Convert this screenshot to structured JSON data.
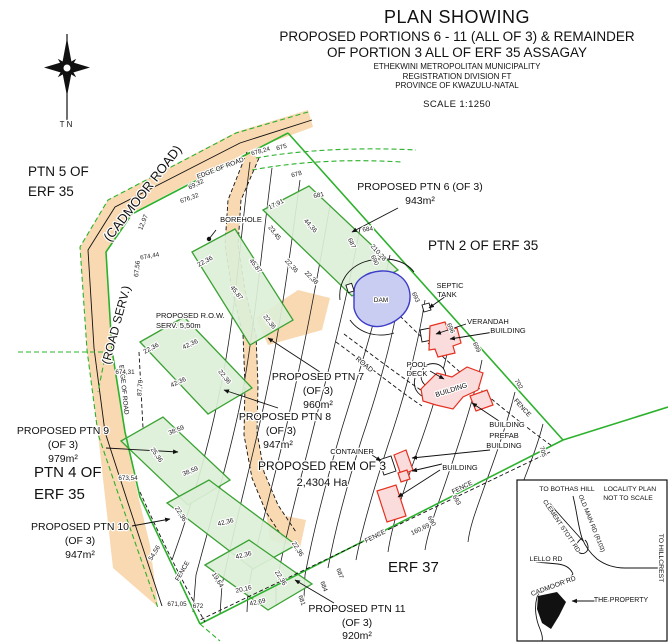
{
  "header": {
    "title1": "PLAN SHOWING",
    "title2": "PROPOSED PORTIONS 6 - 11 (ALL OF 3) & REMAINDER",
    "title3": "OF PORTION 3 ALL OF ERF 35 ASSAGAY",
    "sub1": "ETHEKWINI METROPOLITAN MUNICIPALITY",
    "sub2": "REGISTRATION DIVISION FT",
    "sub3": "PROVINCE OF KWAZULU-NATAL",
    "scale": "SCALE 1:1250"
  },
  "colors": {
    "road": "#f8d9b2",
    "green": "#2cb12c",
    "pfill": "#dcefd8",
    "pstroke": "#3aa233",
    "dfill": "#c9cdf2",
    "dstroke": "#3c3cc8",
    "bfill": "#fbdcdc",
    "bstroke": "#e5301f"
  },
  "labels": [
    {
      "n": "north-label",
      "t": "T N",
      "x": 66,
      "y": 127,
      "c": "feat",
      "s": 8
    },
    {
      "n": "area-label-ptn5",
      "t": "PTN 5 OF",
      "x": 28,
      "y": 176,
      "c": "area",
      "a": "s"
    },
    {
      "n": "area-label-ptn5b",
      "t": "ERF 35",
      "x": 28,
      "y": 196,
      "c": "area",
      "a": "s"
    },
    {
      "n": "area-label-ptn2",
      "t": "PTN 2 OF ERF 35",
      "x": 428,
      "y": 250,
      "c": "area",
      "a": "s"
    },
    {
      "n": "area-label-ptn4",
      "t": "PTN 4 OF",
      "x": 34,
      "y": 477,
      "c": "area",
      "s": 15,
      "a": "s"
    },
    {
      "n": "area-label-ptn4b",
      "t": "ERF 35",
      "x": 34,
      "y": 499,
      "c": "area",
      "s": 15,
      "a": "s"
    },
    {
      "n": "area-label-erf37",
      "t": "ERF 37",
      "x": 388,
      "y": 572,
      "c": "area",
      "s": 15,
      "a": "s"
    },
    {
      "n": "road-name-cadmoor",
      "t": "(CADMOOR ROAD)",
      "x": 146,
      "y": 196,
      "r": -52,
      "c": "area",
      "s": 13
    },
    {
      "n": "road-name-roadserv",
      "t": "(ROAD SERV.)",
      "x": 120,
      "y": 326,
      "r": -75,
      "c": "area",
      "s": 12
    },
    {
      "n": "ptn6-label",
      "t": "PROPOSED PTN 6 (OF 3)",
      "x": 420,
      "y": 190,
      "c": "ptn"
    },
    {
      "n": "ptn6-area",
      "t": "943m²",
      "x": 420,
      "y": 204,
      "c": "ptn"
    },
    {
      "n": "ptn7-label",
      "t": "PROPOSED PTN 7",
      "x": 318,
      "y": 380,
      "c": "ptn"
    },
    {
      "n": "ptn7-of3",
      "t": "(OF 3)",
      "x": 318,
      "y": 394,
      "c": "ptn"
    },
    {
      "n": "ptn7-area",
      "t": "960m²",
      "x": 318,
      "y": 408,
      "c": "ptn"
    },
    {
      "n": "ptn8-label",
      "t": "PROPOSED PTN 8",
      "x": 285,
      "y": 420,
      "c": "ptn"
    },
    {
      "n": "ptn8-of3",
      "t": "(OF 3)",
      "x": 281,
      "y": 434,
      "c": "ptn"
    },
    {
      "n": "ptn8-area",
      "t": "947m²",
      "x": 278,
      "y": 448,
      "c": "ptn"
    },
    {
      "n": "ptn9-label",
      "t": "PROPOSED PTN 9",
      "x": 63,
      "y": 434,
      "c": "ptn"
    },
    {
      "n": "ptn9-of3",
      "t": "(OF 3)",
      "x": 63,
      "y": 448,
      "c": "ptn"
    },
    {
      "n": "ptn9-area",
      "t": "979m²",
      "x": 63,
      "y": 462,
      "c": "ptn"
    },
    {
      "n": "ptn10-label",
      "t": "PROPOSED PTN 10",
      "x": 80,
      "y": 530,
      "c": "ptn"
    },
    {
      "n": "ptn10-of3",
      "t": "(OF 3)",
      "x": 80,
      "y": 544,
      "c": "ptn"
    },
    {
      "n": "ptn10-area",
      "t": "947m²",
      "x": 80,
      "y": 558,
      "c": "ptn"
    },
    {
      "n": "ptn11-label",
      "t": "PROPOSED PTN 11",
      "x": 357,
      "y": 612,
      "c": "ptn"
    },
    {
      "n": "ptn11-of3",
      "t": "(OF 3)",
      "x": 357,
      "y": 626,
      "c": "ptn"
    },
    {
      "n": "ptn11-area",
      "t": "920m²",
      "x": 357,
      "y": 639,
      "c": "ptn"
    },
    {
      "n": "rem-label",
      "t": "PROPOSED REM OF 3",
      "x": 322,
      "y": 470,
      "c": "ptn",
      "s": 12
    },
    {
      "n": "rem-area",
      "t": "2,4304 Ha",
      "x": 322,
      "y": 486,
      "c": "ptn",
      "s": 11
    },
    {
      "n": "row-serv-label",
      "t": "PROPOSED R.O.W.",
      "x": 156,
      "y": 318,
      "c": "feat",
      "a": "s"
    },
    {
      "n": "row-serv-label2",
      "t": "SERV. 5,50m",
      "x": 156,
      "y": 328,
      "c": "feat",
      "a": "s"
    },
    {
      "n": "borehole-label",
      "t": "BOREHOLE",
      "x": 241,
      "y": 222,
      "c": "feat"
    },
    {
      "n": "septic-label",
      "t": "SEPTIC",
      "x": 450,
      "y": 288,
      "c": "feat"
    },
    {
      "n": "septic-label2",
      "t": "TANK",
      "x": 447,
      "y": 297,
      "c": "feat"
    },
    {
      "n": "verandah-label",
      "t": "VERANDAH",
      "x": 488,
      "y": 324,
      "c": "feat"
    },
    {
      "n": "building-label-top",
      "t": "BUILDING",
      "x": 508,
      "y": 333,
      "c": "feat"
    },
    {
      "n": "pool-label",
      "t": "POOL",
      "x": 417,
      "y": 367,
      "c": "feat"
    },
    {
      "n": "pool-label2",
      "t": "DECK",
      "x": 417,
      "y": 376,
      "c": "feat"
    },
    {
      "n": "dam-label",
      "t": "DAM",
      "x": 381,
      "y": 302,
      "c": "feat",
      "s": 6.5
    },
    {
      "n": "building-label-main",
      "t": "BUILDING",
      "x": 452,
      "y": 392,
      "r": -18,
      "c": "feat",
      "s": 7
    },
    {
      "n": "building-label-mid",
      "t": "BUILDING",
      "x": 507,
      "y": 427,
      "c": "feat"
    },
    {
      "n": "prefab-label",
      "t": "PREFAB",
      "x": 504,
      "y": 438,
      "c": "feat"
    },
    {
      "n": "prefab-label2",
      "t": "BUILDING",
      "x": 504,
      "y": 448,
      "c": "feat"
    },
    {
      "n": "container-label",
      "t": "CONTAINER",
      "x": 352,
      "y": 454,
      "c": "feat"
    },
    {
      "n": "building-label-right",
      "t": "BUILDING",
      "x": 460,
      "y": 470,
      "c": "feat"
    },
    {
      "n": "road-label",
      "t": "ROAD",
      "x": 363,
      "y": 366,
      "r": 40,
      "c": "feat",
      "s": 7
    },
    {
      "n": "fence-label-1",
      "t": "FENCE",
      "x": 521,
      "y": 409,
      "r": 48,
      "c": "feat",
      "s": 6.5
    },
    {
      "n": "fence-label-2",
      "t": "FENCE",
      "x": 463,
      "y": 489,
      "r": -27,
      "c": "feat",
      "s": 6.5
    },
    {
      "n": "fence-label-3",
      "t": "FENCE",
      "x": 376,
      "y": 538,
      "r": -27,
      "c": "feat",
      "s": 6.5
    },
    {
      "n": "fence-label-4",
      "t": "FENCE",
      "x": 184,
      "y": 572,
      "r": -60,
      "c": "feat",
      "s": 6.5
    },
    {
      "n": "edge-of-road-label-1",
      "t": "EDGE OF ROAD",
      "x": 221,
      "y": 170,
      "r": -21,
      "c": "feat",
      "s": 6.5
    },
    {
      "n": "edge-of-road-label-2",
      "t": "EDGE OF ROAD",
      "x": 122,
      "y": 390,
      "r": 84,
      "c": "feat",
      "s": 6.5
    },
    {
      "n": "dim-label",
      "t": "69,32",
      "x": 197,
      "y": 186,
      "r": -26,
      "c": "dim"
    },
    {
      "n": "dim-label",
      "t": "12,97",
      "x": 145,
      "y": 223,
      "r": -68,
      "c": "dim"
    },
    {
      "n": "dim-label",
      "t": "67,56",
      "x": 139,
      "y": 269,
      "r": -84,
      "c": "dim"
    },
    {
      "n": "dim-label",
      "t": "87,79",
      "x": 142,
      "y": 388,
      "r": -86,
      "c": "dim"
    },
    {
      "n": "dim-label",
      "t": "210,28",
      "x": 377,
      "y": 254,
      "r": 48,
      "c": "dim"
    },
    {
      "n": "dim-label",
      "t": "160,69",
      "x": 421,
      "y": 531,
      "r": -26,
      "c": "dim"
    },
    {
      "n": "dim-label",
      "t": "54,56",
      "x": 156,
      "y": 554,
      "r": -58,
      "c": "dim"
    },
    {
      "n": "dim-label",
      "t": "17,91",
      "x": 277,
      "y": 206,
      "r": -26,
      "c": "dim"
    },
    {
      "n": "dim-label",
      "t": "23,45",
      "x": 273,
      "y": 234,
      "r": 52,
      "c": "dim"
    },
    {
      "n": "dim-label",
      "t": "44,36",
      "x": 309,
      "y": 227,
      "r": 48,
      "c": "dim"
    },
    {
      "n": "dim-label",
      "t": "22,36",
      "x": 290,
      "y": 267,
      "r": 48,
      "c": "dim"
    },
    {
      "n": "dim-label",
      "t": "22,38",
      "x": 310,
      "y": 279,
      "r": 45,
      "c": "dim"
    },
    {
      "n": "dim-label",
      "t": "22,36",
      "x": 206,
      "y": 263,
      "r": -28,
      "c": "dim"
    },
    {
      "n": "dim-label",
      "t": "45,87",
      "x": 254,
      "y": 267,
      "r": 52,
      "c": "dim"
    },
    {
      "n": "dim-label",
      "t": "45,87",
      "x": 235,
      "y": 294,
      "r": 52,
      "c": "dim"
    },
    {
      "n": "dim-label",
      "t": "22,36",
      "x": 268,
      "y": 323,
      "r": 52,
      "c": "dim"
    },
    {
      "n": "dim-label",
      "t": "22,36",
      "x": 152,
      "y": 350,
      "r": -28,
      "c": "dim"
    },
    {
      "n": "dim-label",
      "t": "42,36",
      "x": 191,
      "y": 346,
      "r": -25,
      "c": "dim"
    },
    {
      "n": "dim-label",
      "t": "42,36",
      "x": 179,
      "y": 384,
      "r": -25,
      "c": "dim"
    },
    {
      "n": "dim-label",
      "t": "22,36",
      "x": 223,
      "y": 378,
      "r": 52,
      "c": "dim"
    },
    {
      "n": "dim-label",
      "t": "38,59",
      "x": 177,
      "y": 432,
      "r": -22,
      "c": "dim"
    },
    {
      "n": "dim-label",
      "t": "25,36",
      "x": 155,
      "y": 456,
      "r": 55,
      "c": "dim"
    },
    {
      "n": "dim-label",
      "t": "38,59",
      "x": 191,
      "y": 473,
      "r": -22,
      "c": "dim"
    },
    {
      "n": "dim-label",
      "t": "22,36",
      "x": 179,
      "y": 515,
      "r": 58,
      "c": "dim"
    },
    {
      "n": "dim-label",
      "t": "42,36",
      "x": 226,
      "y": 524,
      "r": -14,
      "c": "dim"
    },
    {
      "n": "dim-label",
      "t": "42,36",
      "x": 244,
      "y": 557,
      "r": -14,
      "c": "dim"
    },
    {
      "n": "dim-label",
      "t": "22,36",
      "x": 296,
      "y": 550,
      "r": 58,
      "c": "dim"
    },
    {
      "n": "dim-label",
      "t": "19,64",
      "x": 216,
      "y": 581,
      "r": 58,
      "c": "dim"
    },
    {
      "n": "dim-label",
      "t": "20,16",
      "x": 244,
      "y": 591,
      "r": -12,
      "c": "dim"
    },
    {
      "n": "dim-label",
      "t": "42,69",
      "x": 258,
      "y": 604,
      "r": -12,
      "c": "dim"
    },
    {
      "n": "dim-label",
      "t": "22,36",
      "x": 279,
      "y": 579,
      "r": 58,
      "c": "dim"
    },
    {
      "n": "contour-label",
      "t": "675",
      "x": 282,
      "y": 149,
      "r": -15,
      "c": "cont"
    },
    {
      "n": "spot-height",
      "t": "678,24",
      "x": 261,
      "y": 153,
      "r": -15,
      "c": "cont"
    },
    {
      "n": "contour-label",
      "t": "678",
      "x": 297,
      "y": 176,
      "r": -15,
      "c": "cont"
    },
    {
      "n": "contour-label",
      "t": "681",
      "x": 319,
      "y": 197,
      "r": -12,
      "c": "cont"
    },
    {
      "n": "contour-label",
      "t": "684",
      "x": 368,
      "y": 231,
      "r": -8,
      "c": "cont"
    },
    {
      "n": "contour-label",
      "t": "687",
      "x": 350,
      "y": 244,
      "r": 65,
      "c": "cont"
    },
    {
      "n": "contour-label",
      "t": "690",
      "x": 373,
      "y": 261,
      "r": 65,
      "c": "cont"
    },
    {
      "n": "contour-label",
      "t": "693",
      "x": 414,
      "y": 298,
      "r": 65,
      "c": "cont"
    },
    {
      "n": "contour-label",
      "t": "696",
      "x": 449,
      "y": 329,
      "r": 65,
      "c": "cont"
    },
    {
      "n": "contour-label",
      "t": "699",
      "x": 475,
      "y": 348,
      "r": 65,
      "c": "cont"
    },
    {
      "n": "contour-label",
      "t": "702",
      "x": 517,
      "y": 385,
      "r": 60,
      "c": "cont"
    },
    {
      "n": "contour-label",
      "t": "705",
      "x": 541,
      "y": 452,
      "r": 75,
      "c": "cont"
    },
    {
      "n": "contour-label",
      "t": "687",
      "x": 338,
      "y": 574,
      "r": 70,
      "c": "cont"
    },
    {
      "n": "contour-label",
      "t": "684",
      "x": 322,
      "y": 587,
      "r": 70,
      "c": "cont"
    },
    {
      "n": "contour-label",
      "t": "681",
      "x": 300,
      "y": 601,
      "r": 70,
      "c": "cont"
    },
    {
      "n": "contour-label",
      "t": "690",
      "x": 430,
      "y": 522,
      "r": 60,
      "c": "cont"
    },
    {
      "n": "contour-label",
      "t": "693",
      "x": 455,
      "y": 501,
      "r": 60,
      "c": "cont"
    },
    {
      "n": "spot-height",
      "t": "676,32",
      "x": 190,
      "y": 200,
      "r": -20,
      "c": "cont"
    },
    {
      "n": "spot-height",
      "t": "674,44",
      "x": 150,
      "y": 258,
      "r": -10,
      "c": "cont"
    },
    {
      "n": "spot-height",
      "t": "674,31",
      "x": 125,
      "y": 374,
      "c": "cont"
    },
    {
      "n": "spot-height",
      "t": "673,54",
      "x": 128,
      "y": 480,
      "c": "cont"
    },
    {
      "n": "spot-height",
      "t": "671,05",
      "x": 177,
      "y": 606,
      "c": "cont"
    },
    {
      "n": "spot-height",
      "t": "672",
      "x": 198,
      "y": 608,
      "c": "cont"
    },
    {
      "n": "inset-label",
      "t": "TO BOTHAS HILL",
      "x": 567,
      "y": 491,
      "c": "inset"
    },
    {
      "n": "inset-label",
      "t": "LOCALITY PLAN",
      "x": 630,
      "y": 491,
      "c": "inset"
    },
    {
      "n": "inset-label",
      "t": "NOT TO SCALE",
      "x": 628,
      "y": 500,
      "c": "inset"
    },
    {
      "n": "inset-road-label",
      "t": "OLD MAIN RD (R103)",
      "x": 590,
      "y": 524,
      "r": 68,
      "c": "inset",
      "s": 6.2
    },
    {
      "n": "inset-road-label",
      "t": "CLEMENT STOTT RD",
      "x": 560,
      "y": 527,
      "r": 56,
      "c": "inset",
      "s": 6.2
    },
    {
      "n": "inset-road-label",
      "t": "LELLO RD",
      "x": 546,
      "y": 561,
      "c": "inset"
    },
    {
      "n": "inset-label",
      "t": "TO HILLCREST",
      "x": 659,
      "y": 558,
      "r": 90,
      "c": "inset"
    },
    {
      "n": "inset-road-label",
      "t": "CADMOOR RD",
      "x": 554,
      "y": 588,
      "r": -20,
      "c": "inset"
    },
    {
      "n": "inset-property-label",
      "t": "THE PROPERTY",
      "x": 621,
      "y": 602,
      "c": "inset",
      "s": 7
    }
  ]
}
